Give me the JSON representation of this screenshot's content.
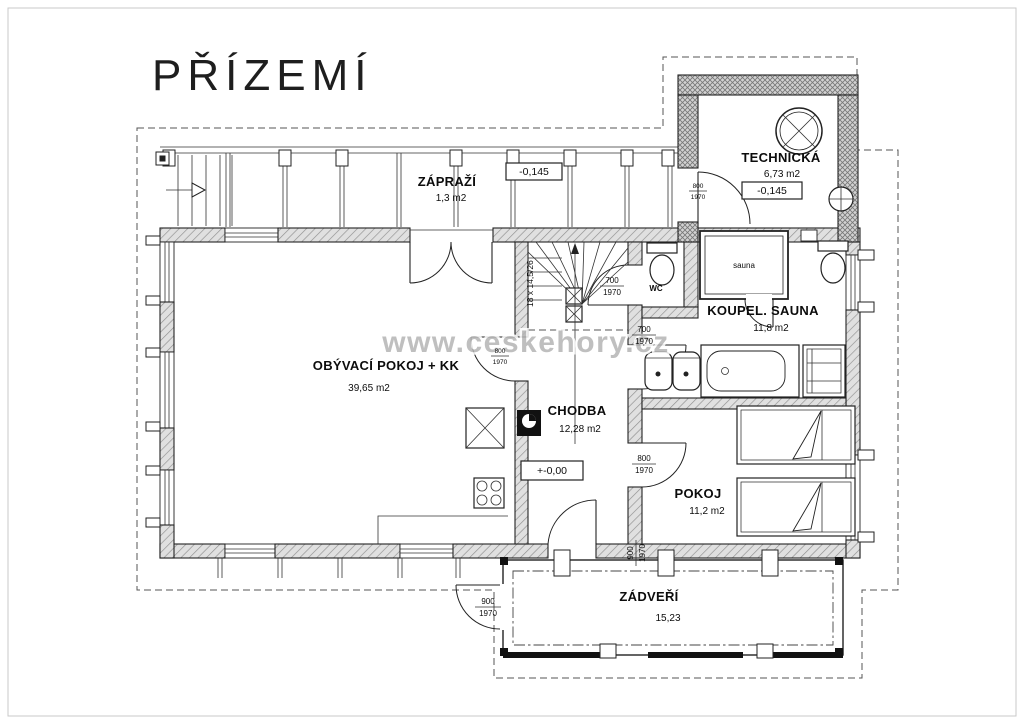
{
  "title": "PŘÍZEMÍ",
  "watermark": "www.ceskehory.cz",
  "rooms": {
    "zaprazi": {
      "name": "ZÁPRAŽÍ",
      "area": "1,3 m2"
    },
    "technicka": {
      "name": "TECHNICKÁ",
      "area": "6,73 m2"
    },
    "obyvaci": {
      "name": "OBÝVACÍ POKOJ + KK",
      "area": "39,65 m2"
    },
    "chodba": {
      "name": "CHODBA",
      "area": "12,28 m2"
    },
    "koupel": {
      "name": "KOUPEL. SAUNA",
      "area": "11,8 m2"
    },
    "wc": {
      "name": "WC"
    },
    "sauna": {
      "name": "sauna"
    },
    "pokoj": {
      "name": "POKOJ",
      "area": "11,2 m2"
    },
    "zadveri": {
      "name": "ZÁDVEŘÍ",
      "area": "15,23"
    }
  },
  "elevations": {
    "zaprazi": "-0,145",
    "technicka": "-0,145",
    "chodba": "+-0,00"
  },
  "stairs": {
    "note": "18 x 14,5/26"
  },
  "doors": {
    "technicka": {
      "w": "800",
      "h": "1970"
    },
    "wc": {
      "w": "700",
      "h": "1970"
    },
    "koupelna": {
      "w": "700",
      "h": "1970"
    },
    "obyvaci": {
      "w": "800",
      "h": "1970"
    },
    "pokoj": {
      "w": "800",
      "h": "1970"
    },
    "zadveri_inner": {
      "w": "900",
      "h": "1970"
    },
    "zadveri_outer": {
      "w": "900",
      "h": "1970"
    }
  }
}
